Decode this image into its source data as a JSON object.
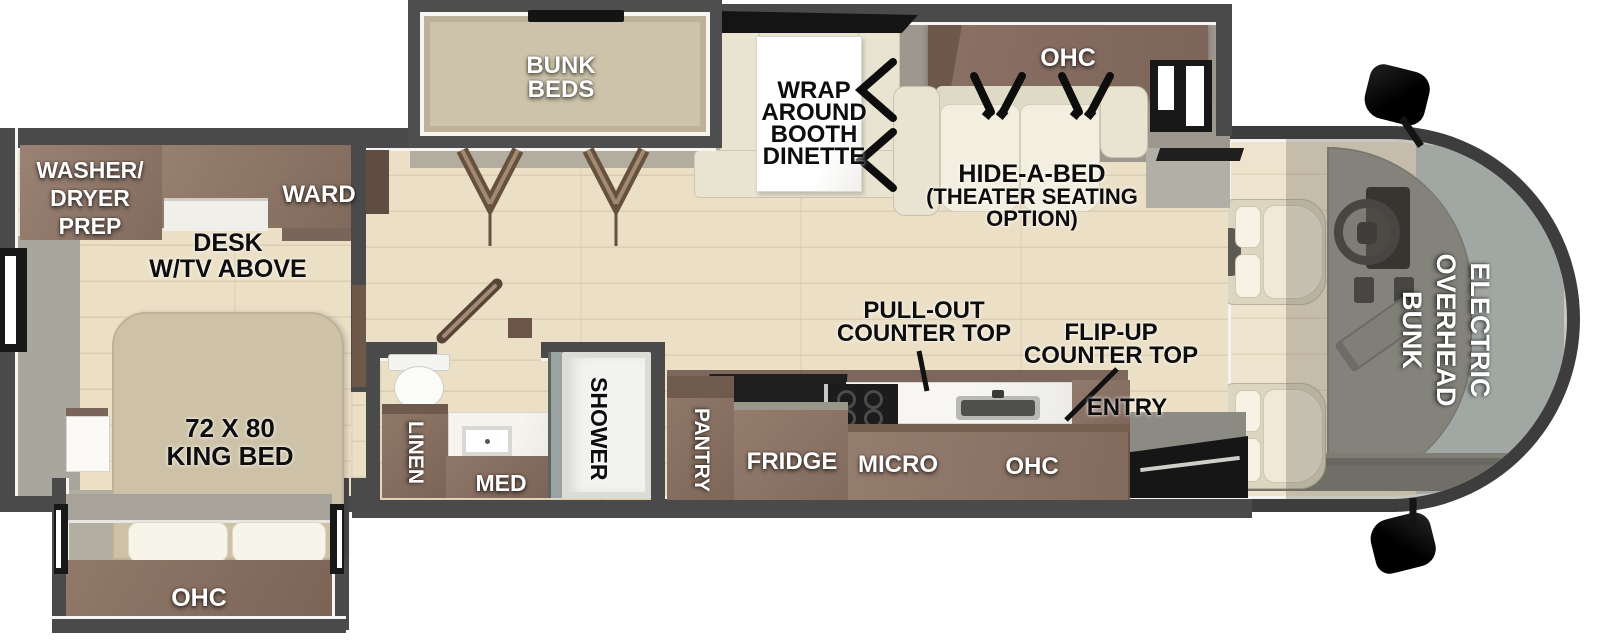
{
  "title": "Class C motorhome floor plan",
  "labels": {
    "washer_dryer_prep": {
      "l1": "WASHER/",
      "l2": "DRYER",
      "l3": "PREP"
    },
    "ward": "WARD",
    "desk": {
      "l1": "DESK",
      "l2": "W/TV ABOVE"
    },
    "king_bed": {
      "l1": "72 X 80",
      "l2": "KING BED"
    },
    "bedroom_ohc": "OHC",
    "bunk_beds": {
      "l1": "BUNK",
      "l2": "BEDS"
    },
    "dinette": {
      "l1": "WRAP",
      "l2": "AROUND",
      "l3": "BOOTH",
      "l4": "DINETTE"
    },
    "living_ohc": "OHC",
    "hide_a_bed": {
      "l1": "HIDE-A-BED",
      "l2": "(THEATER SEATING",
      "l3": "OPTION)"
    },
    "linen": "LINEN",
    "med": "MED",
    "shower": "SHOWER",
    "pantry": "PANTRY",
    "fridge": "FRIDGE",
    "micro": "MICRO",
    "kitchen_ohc": "OHC",
    "pull_out_counter": {
      "l1": "PULL-OUT",
      "l2": "COUNTER TOP"
    },
    "flip_up_counter": {
      "l1": "FLIP-UP",
      "l2": "COUNTER TOP"
    },
    "entry": "ENTRY",
    "overhead_bunk": {
      "l1": "ELECTRIC",
      "l2": "OVERHEAD",
      "l3": "BUNK"
    }
  },
  "colors": {
    "wall": "#4a4a4a",
    "trim": "#f6f5f1",
    "floor_wood": "#ebdfc6",
    "walkway_gray": "#a9a69d",
    "cabinet_brown": "#8a7164",
    "mattress_tan": "#cdc2a7",
    "sofa_cream": "#e9e4d1",
    "marble_white": "#f6f4ef",
    "windshield": "#bac4c2",
    "black": "#181818",
    "label_white": "#ffffff",
    "label_black": "#0d0d0d"
  }
}
